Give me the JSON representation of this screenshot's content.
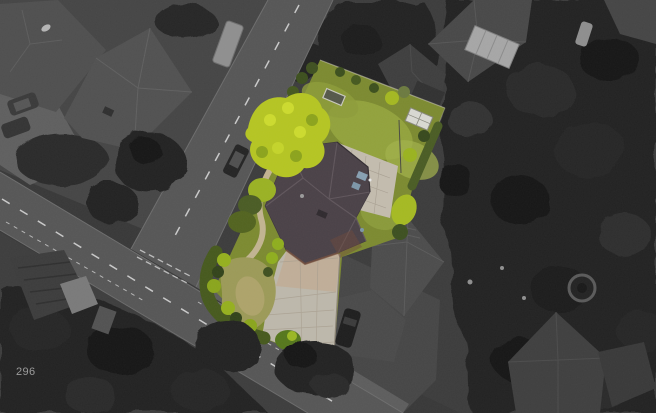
{
  "view": {
    "overlay_label": "296",
    "kind": "aerial-photo-with-highlighted-plot"
  },
  "palette": {
    "background": "#383838",
    "ground": "#454545",
    "road": "#565656",
    "road_marking": "#c9c9c9",
    "building": "#4d4d4d",
    "trees_dark": "#212121",
    "highlight_lawn": "#7c8a30",
    "bright_foliage": "#b5c522",
    "dark_foliage": "#3f5020",
    "roof": "#4a4147",
    "patio": "#c3bcae",
    "driveway": "#bdb8ab",
    "path": "#c2b491",
    "furniture_blue": "#87a0b2",
    "car_dark": "#1e1e1e",
    "label_text": "#9b9b9b"
  }
}
